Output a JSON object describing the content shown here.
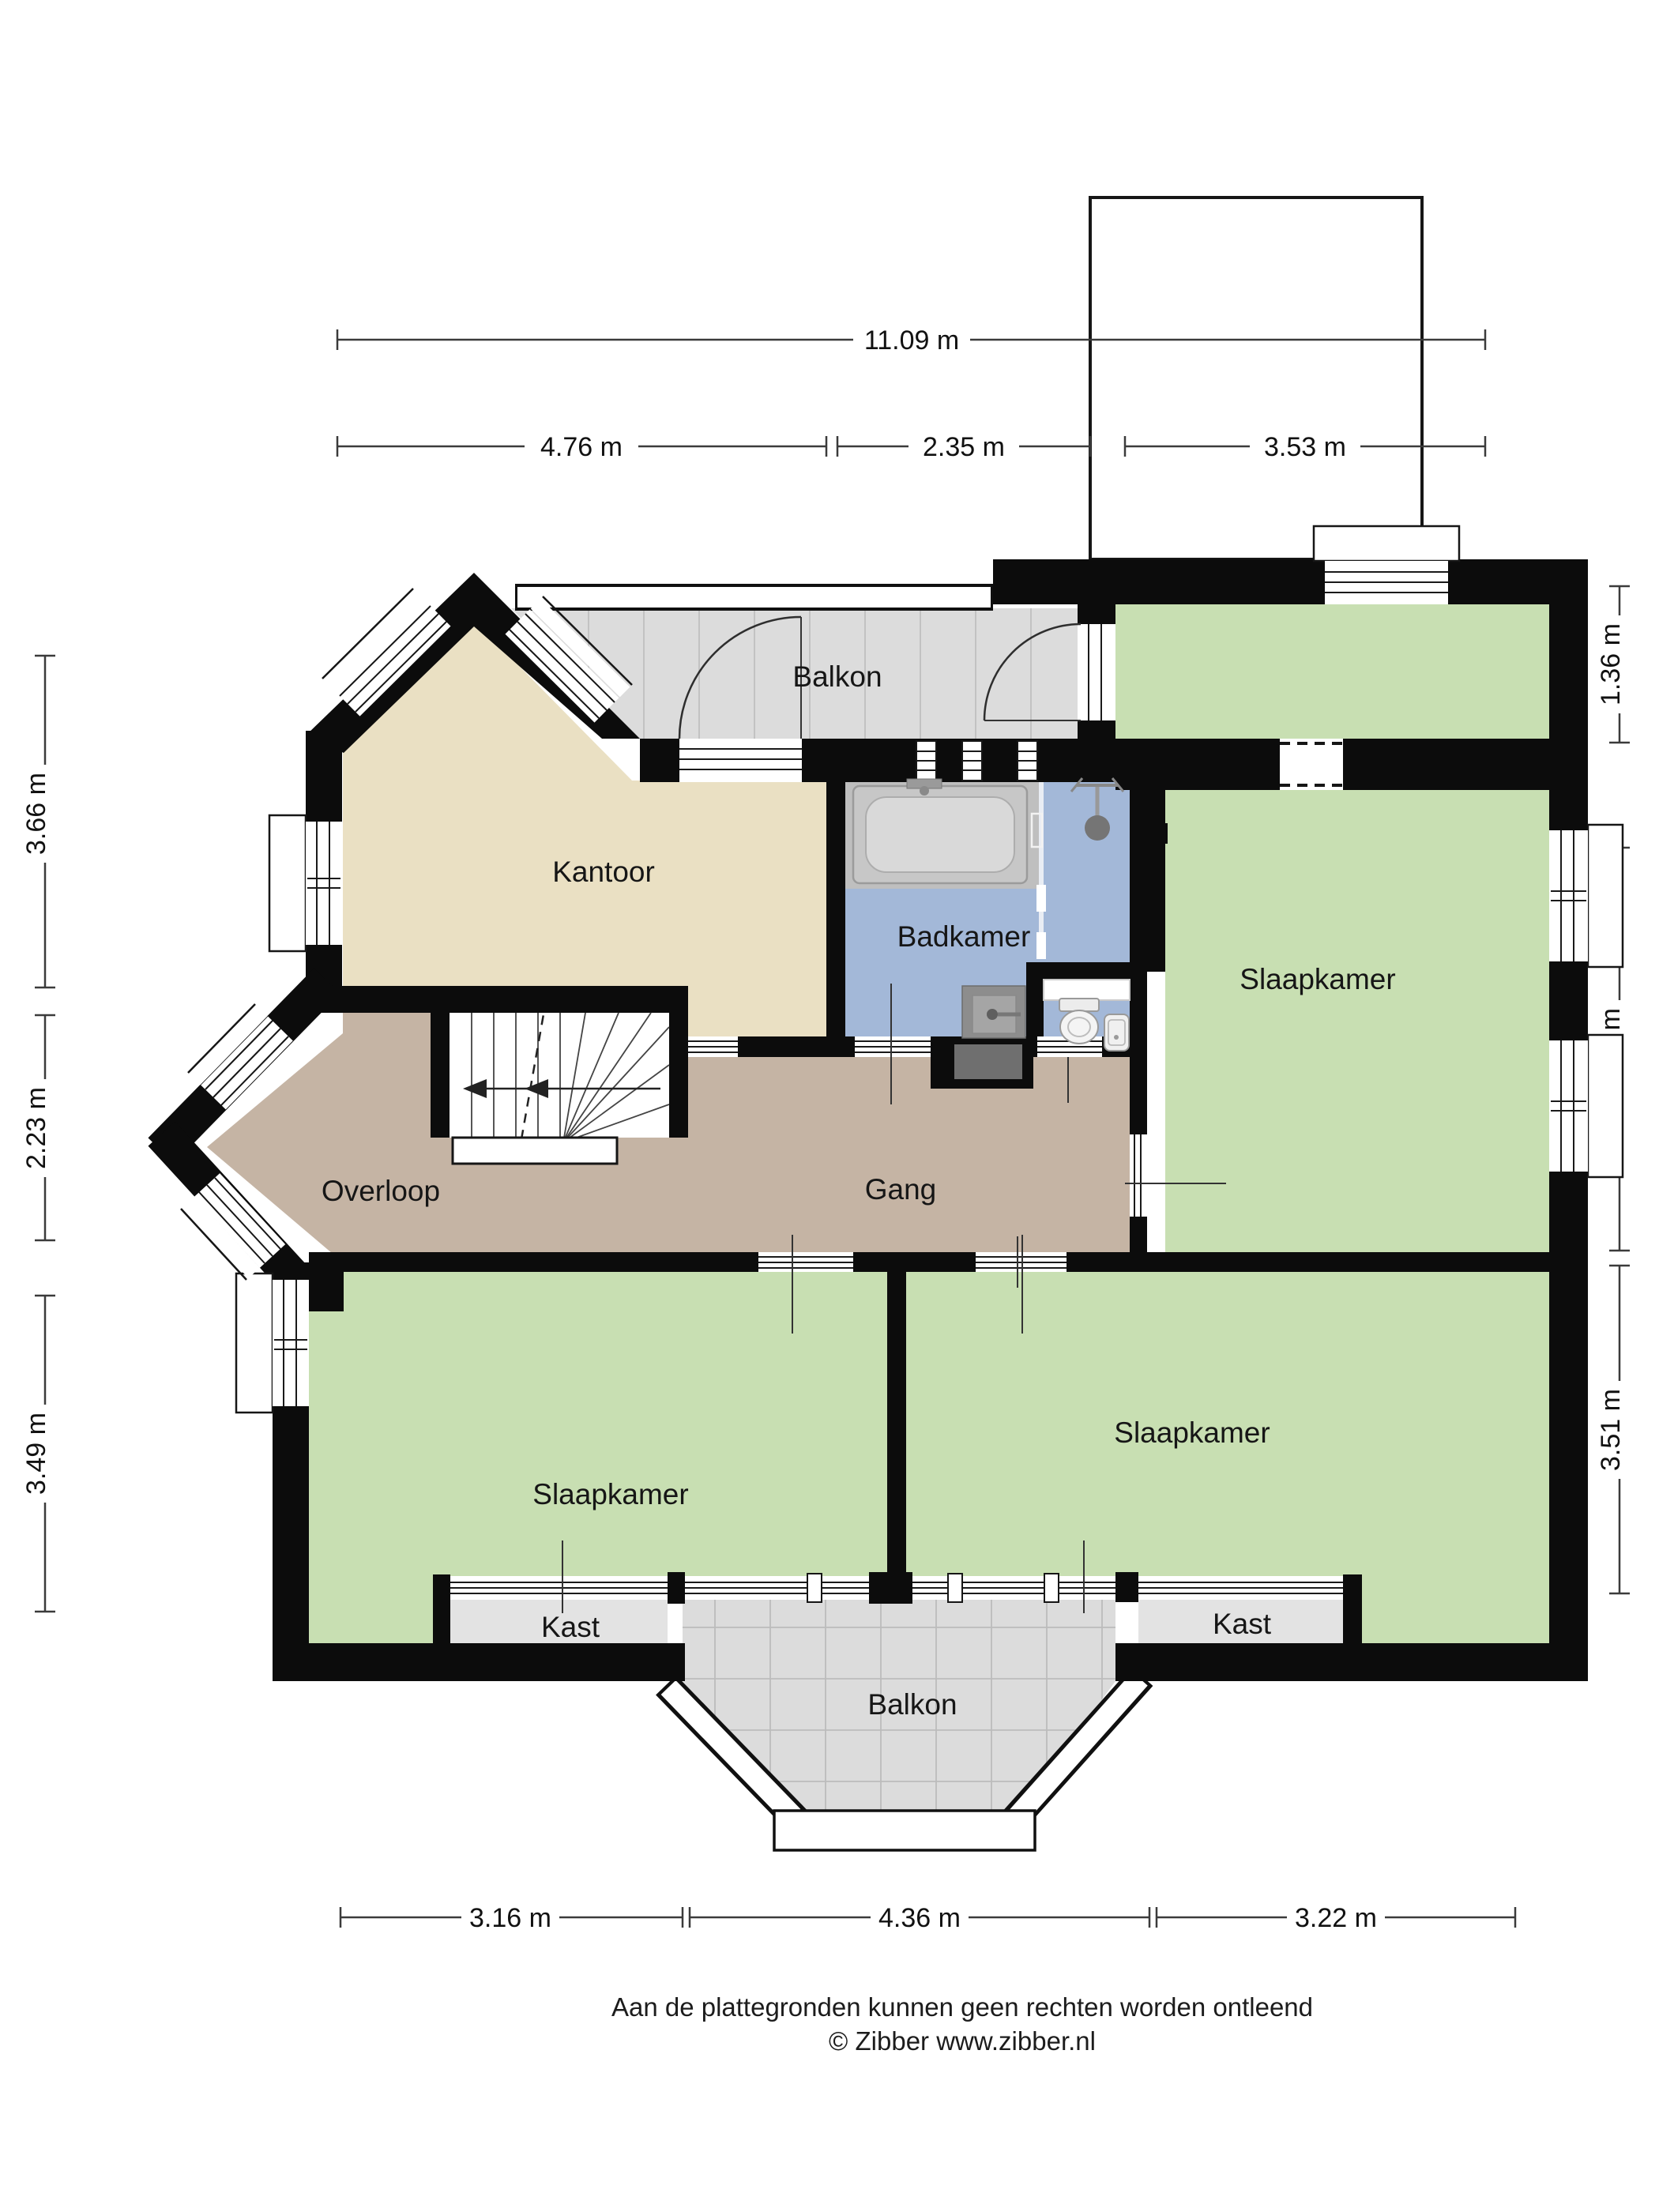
{
  "plan": {
    "rooms": [
      {
        "id": "balkon-top",
        "label": "Balkon"
      },
      {
        "id": "kantoor",
        "label": "Kantoor"
      },
      {
        "id": "badkamer",
        "label": "Badkamer"
      },
      {
        "id": "slaapkamer-right",
        "label": "Slaapkamer"
      },
      {
        "id": "overloop",
        "label": "Overloop"
      },
      {
        "id": "gang",
        "label": "Gang"
      },
      {
        "id": "slaapkamer-bottom-left",
        "label": "Slaapkamer"
      },
      {
        "id": "slaapkamer-bottom-right",
        "label": "Slaapkamer"
      },
      {
        "id": "kast-left",
        "label": "Kast"
      },
      {
        "id": "kast-right",
        "label": "Kast"
      },
      {
        "id": "balkon-bottom",
        "label": "Balkon"
      }
    ],
    "dimensions": {
      "top_total": "11.09 m",
      "top": [
        "4.76 m",
        "2.35 m",
        "3.53 m"
      ],
      "left": [
        "3.66 m",
        "2.23 m",
        "3.49 m"
      ],
      "right": [
        "1.36 m",
        "4.66 m",
        "3.51 m"
      ],
      "bottom": [
        "3.16 m",
        "4.36 m",
        "3.22 m"
      ]
    },
    "footer": {
      "disclaimer": "Aan de plattegronden kunnen geen rechten worden ontleend",
      "credit": "© Zibber www.zibber.nl"
    },
    "colors": {
      "wall": "#0c0c0c",
      "bedroom_green": "#c8dfb2",
      "office_beige": "#eae0c3",
      "hall_taupe": "#c5b4a4",
      "bath_blue": "#a3b8d8",
      "balcony_gray": "#dcdcdc",
      "closet_gray": "#e3e3e3"
    }
  }
}
